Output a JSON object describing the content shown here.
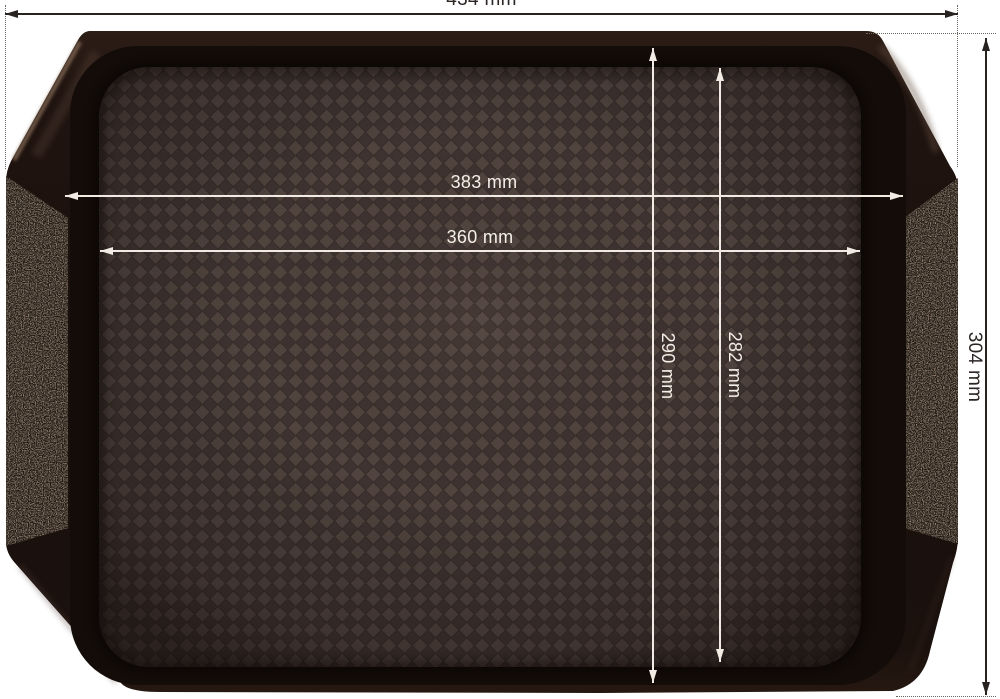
{
  "scene": {
    "background": "#ffffff",
    "product": {
      "description": "dark brown plastic fast-food serving tray with side handles, top view",
      "body_color": "#20150f",
      "floor_tile_light": "#51443f",
      "floor_tile_dark": "#3e3330",
      "speckle_color": "#a5907f"
    }
  },
  "dims": {
    "outer_width": {
      "label": "434 mm"
    },
    "outer_height": {
      "label": "304 mm"
    },
    "basin_width": {
      "label": "383 mm"
    },
    "floor_width": {
      "label": "360 mm"
    },
    "basin_height": {
      "label": "290 mm"
    },
    "floor_height": {
      "label": "282 mm"
    },
    "outside_line_color": "#282320",
    "inside_line_color": "#f1ebe3"
  }
}
